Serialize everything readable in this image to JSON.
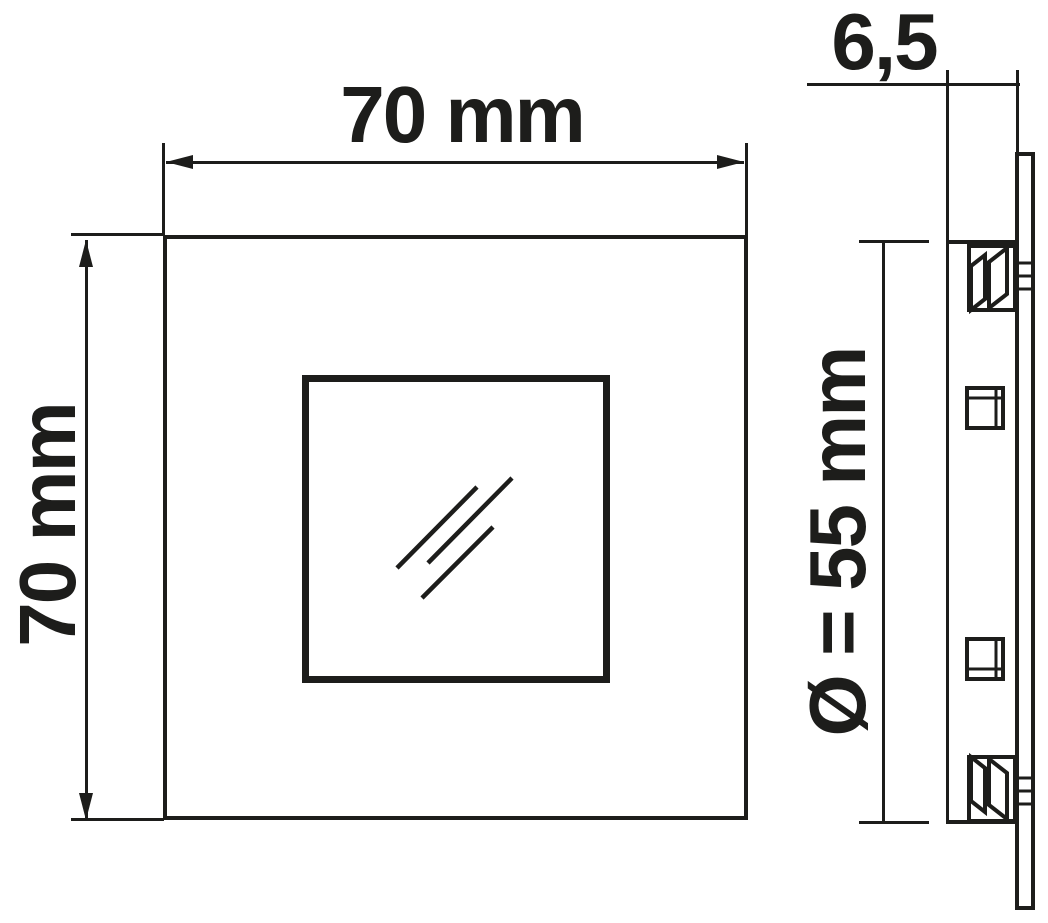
{
  "labels": {
    "front_width": "70 mm",
    "front_height": "70 mm",
    "side_depth": "6,5",
    "side_diameter": "Ø = 55 mm"
  },
  "colors": {
    "ink": "#1d1d1b",
    "background": "#ffffff"
  }
}
